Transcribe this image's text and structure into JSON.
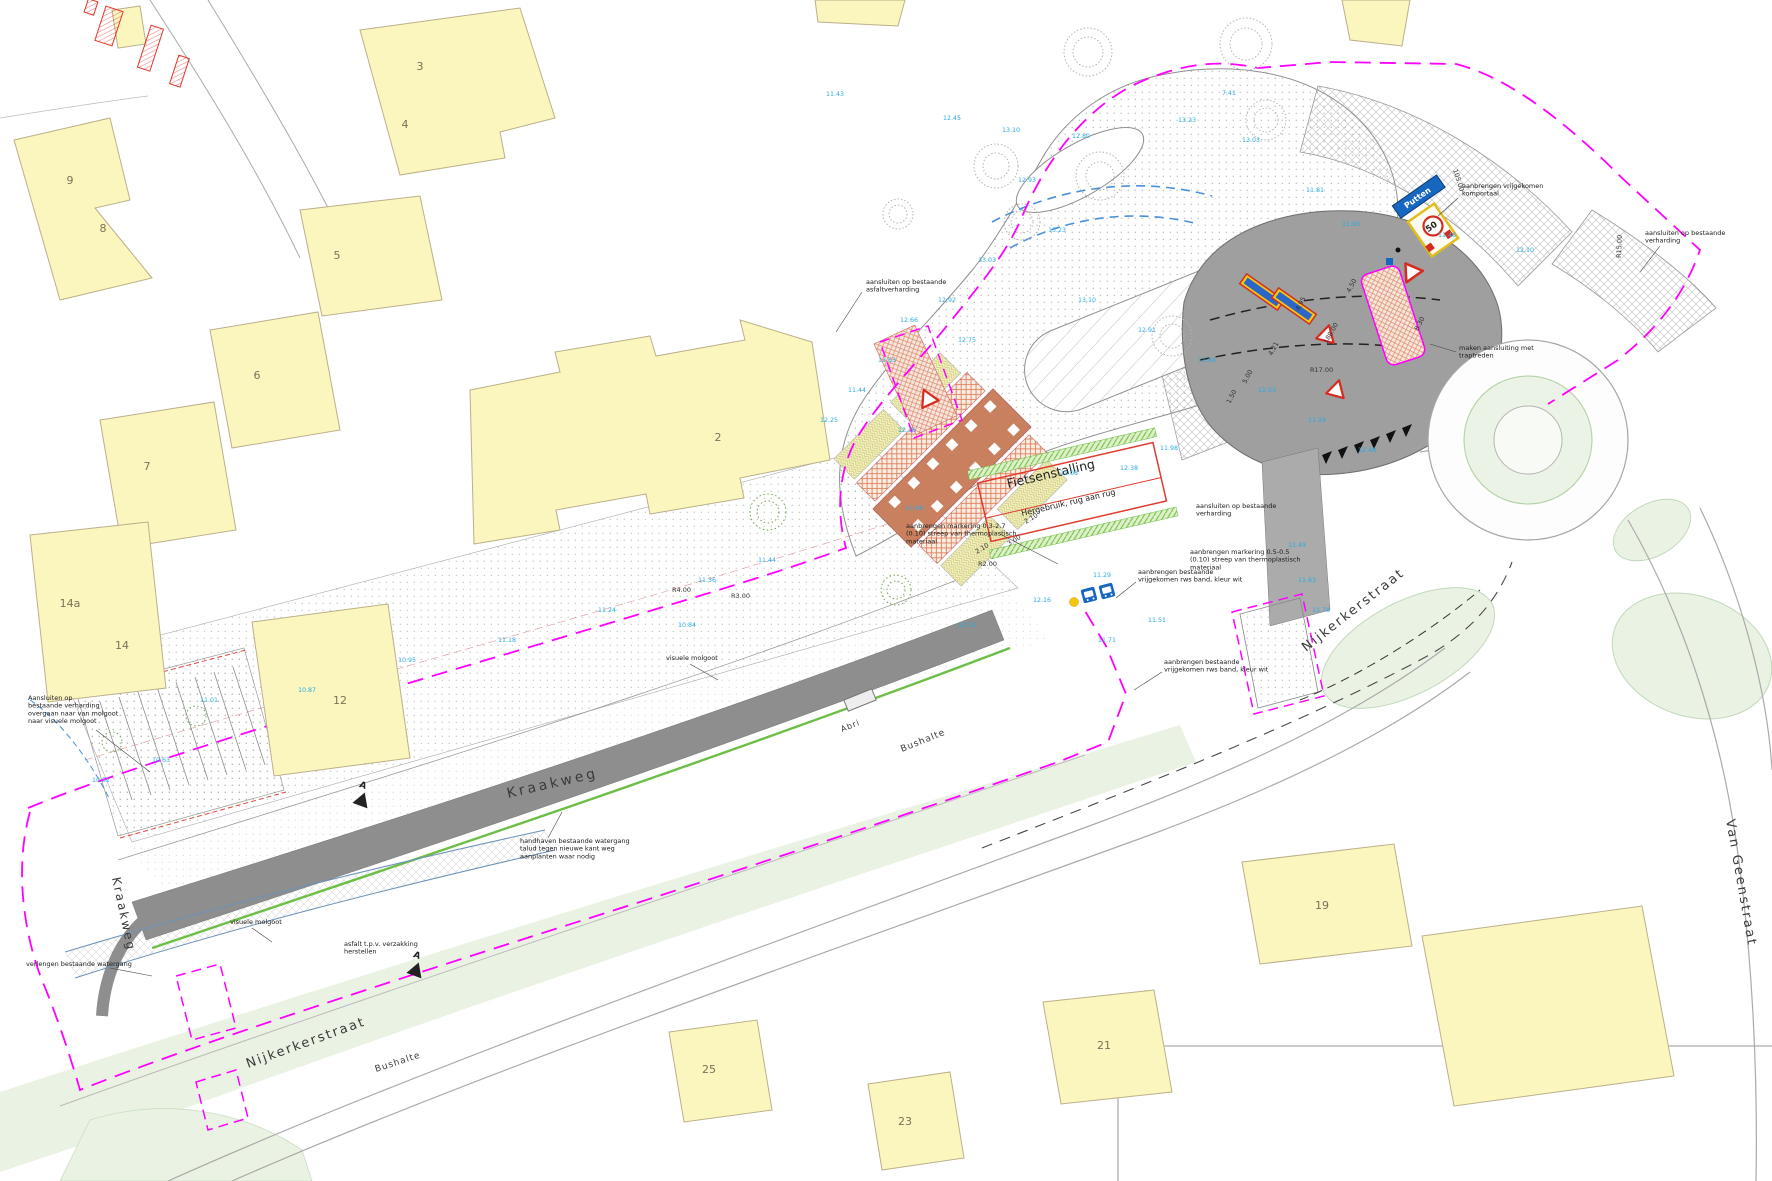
{
  "drawing": {
    "colors": {
      "boundary_magenta": "#FF00FF",
      "spot_height_cyan": "#29ABE2",
      "building_fill": "#FBF5BE",
      "grass_green": "#E9F2E3",
      "sign_blue": "#1766C0",
      "marking_red": "#D62B1F",
      "bikepark_green": "#6CBE45",
      "asphalt_gray": "#8E8E8E"
    },
    "streets": [
      {
        "name": "Kraakweg",
        "x": 508,
        "y": 798,
        "rotate": -13,
        "size": 14,
        "spacing": 3
      },
      {
        "name": "Kraakweg",
        "x": 112,
        "y": 878,
        "rotate": 78,
        "size": 12,
        "spacing": 2
      },
      {
        "name": "Nijkerkerstraat",
        "x": 248,
        "y": 1068,
        "rotate": -20,
        "size": 13,
        "spacing": 2
      },
      {
        "name": "Nijkerkerstraat",
        "x": 1306,
        "y": 652,
        "rotate": -38,
        "size": 13,
        "spacing": 2
      },
      {
        "name": "Van Geenstraat",
        "x": 1726,
        "y": 820,
        "rotate": 80,
        "size": 13,
        "spacing": 2
      },
      {
        "name": "Bushalte",
        "x": 376,
        "y": 1072,
        "rotate": -18,
        "size": 9,
        "spacing": 1
      },
      {
        "name": "Bushalte",
        "x": 902,
        "y": 752,
        "rotate": -22,
        "size": 9,
        "spacing": 1
      },
      {
        "name": "Abri",
        "x": 842,
        "y": 732,
        "rotate": -22,
        "size": 8,
        "spacing": 1
      }
    ],
    "buildings": [
      {
        "number": "3",
        "x": 420,
        "y": 70
      },
      {
        "number": "4",
        "x": 405,
        "y": 128
      },
      {
        "number": "9",
        "x": 70,
        "y": 184
      },
      {
        "number": "8",
        "x": 103,
        "y": 232
      },
      {
        "number": "5",
        "x": 337,
        "y": 259
      },
      {
        "number": "6",
        "x": 257,
        "y": 379
      },
      {
        "number": "7",
        "x": 147,
        "y": 470
      },
      {
        "number": "2",
        "x": 718,
        "y": 441
      },
      {
        "number": "14a",
        "x": 70,
        "y": 607
      },
      {
        "number": "14",
        "x": 122,
        "y": 649
      },
      {
        "number": "12",
        "x": 340,
        "y": 704
      },
      {
        "number": "19",
        "x": 1322,
        "y": 909
      },
      {
        "number": "21",
        "x": 1104,
        "y": 1049
      },
      {
        "number": "25",
        "x": 709,
        "y": 1073
      },
      {
        "number": "23",
        "x": 905,
        "y": 1125
      }
    ],
    "annotations": [
      {
        "key": "aansluiten-asfalt",
        "x": 866,
        "y": 284,
        "lines": [
          "aansluiten op bestaande",
          "asfaltverharding"
        ],
        "leader": [
          862,
          292,
          836,
          332
        ]
      },
      {
        "key": "komportaal",
        "x": 1462,
        "y": 188,
        "lines": [
          "aanbrengen vrijgekomen",
          "komportaal"
        ],
        "leader": [
          1458,
          198,
          1438,
          216
        ]
      },
      {
        "key": "aansluiten-verharding-noordoost",
        "x": 1645,
        "y": 235,
        "lines": [
          "aansluiten op bestaande",
          "verharding"
        ],
        "leader": [
          1660,
          246,
          1640,
          272
        ]
      },
      {
        "key": "traptreden",
        "x": 1459,
        "y": 350,
        "lines": [
          "maken aansluiting met",
          "traptreden"
        ],
        "leader": [
          1456,
          352,
          1430,
          344
        ]
      },
      {
        "key": "markering-03-27",
        "x": 906,
        "y": 528,
        "lines": [
          "aanbrengen markering 0.3-2.7",
          "(0.10) streep van thermoplastisch",
          "materiaal"
        ],
        "leader": [
          1000,
          534,
          1058,
          564
        ]
      },
      {
        "key": "aansluiten-verharding-oost",
        "x": 1196,
        "y": 508,
        "lines": [
          "aansluiten op bestaande",
          "verharding"
        ]
      },
      {
        "key": "markering-05-05",
        "x": 1190,
        "y": 554,
        "lines": [
          "aanbrengen markering 0.5-0.5",
          "(0.10) streep van thermoplastisch",
          "materiaal"
        ]
      },
      {
        "key": "rws-band-1",
        "x": 1138,
        "y": 574,
        "lines": [
          "aanbrengen bestaande",
          "vrijgekomen rws band, kleur wit"
        ],
        "leader": [
          1136,
          582,
          1116,
          598
        ]
      },
      {
        "key": "rws-band-2",
        "x": 1164,
        "y": 664,
        "lines": [
          "aanbrengen bestaande",
          "vrijgekomen rws band, kleur wit"
        ],
        "leader": [
          1162,
          672,
          1134,
          690
        ]
      },
      {
        "key": "molgoot-overgang",
        "x": 28,
        "y": 700,
        "lines": [
          "Aansluiten op",
          "bestaande verharding",
          "overgaan naar van molgoot",
          "naar visuele molgoot"
        ],
        "leader": [
          96,
          730,
          150,
          772
        ]
      },
      {
        "key": "watergang-verlengen",
        "x": 26,
        "y": 966,
        "lines": [
          "verlengen bestaande watergang"
        ],
        "leader": [
          110,
          968,
          152,
          976
        ]
      },
      {
        "key": "watergang-handhaven",
        "x": 520,
        "y": 843,
        "lines": [
          "handhaven bestaande watergang",
          "talud tegen nieuwe kant weg",
          "aanplanten waar nodig"
        ],
        "leader": [
          548,
          838,
          562,
          812
        ]
      },
      {
        "key": "visuele-molgoot-1",
        "x": 666,
        "y": 660,
        "lines": [
          "visuele molgoot"
        ],
        "leader": [
          690,
          664,
          718,
          680
        ]
      },
      {
        "key": "visuele-molgoot-2",
        "x": 230,
        "y": 924,
        "lines": [
          "visuele molgoot"
        ],
        "leader": [
          252,
          928,
          272,
          942
        ]
      },
      {
        "key": "asfalt-herstel",
        "x": 344,
        "y": 946,
        "lines": [
          "asfalt t.p.v. verzakking",
          "herstellen"
        ]
      }
    ],
    "poi": [
      {
        "label": "Fietsenstalling",
        "x": 1008,
        "y": 488,
        "rotate": -13,
        "size": 12.5
      },
      {
        "label": "Hergebruik, rug aan rug",
        "x": 1022,
        "y": 516,
        "rotate": -13,
        "size": 8
      }
    ],
    "signs": {
      "direction_label": "Putten",
      "speed_limit": "50"
    },
    "section_markers": [
      {
        "label": "A",
        "x": 362,
        "y": 788,
        "rotate": 20
      },
      {
        "label": "A",
        "x": 416,
        "y": 958,
        "rotate": 20
      }
    ],
    "dimensions": [
      {
        "text": "R15.00",
        "x": 1621,
        "y": 258,
        "rotate": -88
      },
      {
        "text": "R17.00",
        "x": 1310,
        "y": 372,
        "rotate": 0
      },
      {
        "text": "188.00",
        "x": 1327,
        "y": 344,
        "rotate": -60
      },
      {
        "text": "105.00",
        "x": 1453,
        "y": 170,
        "rotate": 72
      },
      {
        "text": "R2.00",
        "x": 978,
        "y": 566,
        "rotate": 0
      },
      {
        "text": "R4.00",
        "x": 672,
        "y": 592,
        "rotate": 0
      },
      {
        "text": "R3.00",
        "x": 731,
        "y": 598,
        "rotate": 0
      },
      {
        "text": "2.10",
        "x": 1026,
        "y": 524,
        "rotate": -32
      },
      {
        "text": "3.00",
        "x": 1009,
        "y": 546,
        "rotate": -32
      },
      {
        "text": "2.10",
        "x": 977,
        "y": 554,
        "rotate": -32
      },
      {
        "text": "4.21",
        "x": 1272,
        "y": 356,
        "rotate": -62
      },
      {
        "text": "4.95",
        "x": 1299,
        "y": 311,
        "rotate": -62
      },
      {
        "text": "4.50",
        "x": 1350,
        "y": 293,
        "rotate": -62
      },
      {
        "text": "8.30",
        "x": 1418,
        "y": 331,
        "rotate": -62
      },
      {
        "text": "5.00",
        "x": 1246,
        "y": 384,
        "rotate": -62
      },
      {
        "text": "1.50",
        "x": 1230,
        "y": 404,
        "rotate": -62
      }
    ],
    "spot_heights": [
      {
        "v": "11.43",
        "x": 826,
        "y": 96
      },
      {
        "v": "12.45",
        "x": 943,
        "y": 120
      },
      {
        "v": "13.10",
        "x": 1002,
        "y": 132
      },
      {
        "v": "12.80",
        "x": 1072,
        "y": 138
      },
      {
        "v": "13.23",
        "x": 1178,
        "y": 122
      },
      {
        "v": "13.03",
        "x": 1242,
        "y": 142
      },
      {
        "v": "11.81",
        "x": 1306,
        "y": 192
      },
      {
        "v": "11.95",
        "x": 1342,
        "y": 226
      },
      {
        "v": "11.48",
        "x": 1438,
        "y": 237
      },
      {
        "v": "12.10",
        "x": 1516,
        "y": 252
      },
      {
        "v": "12.93",
        "x": 1018,
        "y": 182
      },
      {
        "v": "13.23",
        "x": 1048,
        "y": 232
      },
      {
        "v": "13.03",
        "x": 978,
        "y": 262
      },
      {
        "v": "12.92",
        "x": 938,
        "y": 302
      },
      {
        "v": "12.66",
        "x": 900,
        "y": 322
      },
      {
        "v": "12.75",
        "x": 958,
        "y": 342
      },
      {
        "v": "13.63",
        "x": 878,
        "y": 362
      },
      {
        "v": "11.44",
        "x": 848,
        "y": 392
      },
      {
        "v": "12.25",
        "x": 820,
        "y": 422
      },
      {
        "v": "12.16",
        "x": 898,
        "y": 432
      },
      {
        "v": "13.10",
        "x": 1078,
        "y": 302
      },
      {
        "v": "12.91",
        "x": 1138,
        "y": 332
      },
      {
        "v": "11.84",
        "x": 1198,
        "y": 362
      },
      {
        "v": "12.03",
        "x": 1258,
        "y": 392
      },
      {
        "v": "11.29",
        "x": 1308,
        "y": 422
      },
      {
        "v": "12.48",
        "x": 1358,
        "y": 452
      },
      {
        "v": "11.71",
        "x": 1098,
        "y": 642
      },
      {
        "v": "11.51",
        "x": 1148,
        "y": 622
      },
      {
        "v": "11.49",
        "x": 1288,
        "y": 547
      },
      {
        "v": "11.63",
        "x": 1298,
        "y": 582
      },
      {
        "v": "11.78",
        "x": 1312,
        "y": 612
      },
      {
        "v": "12.16",
        "x": 1033,
        "y": 602
      },
      {
        "v": "11.29",
        "x": 1093,
        "y": 577
      },
      {
        "v": "12.10",
        "x": 958,
        "y": 627
      },
      {
        "v": "11.01",
        "x": 200,
        "y": 702
      },
      {
        "v": "10.87",
        "x": 298,
        "y": 692
      },
      {
        "v": "10.95",
        "x": 398,
        "y": 662
      },
      {
        "v": "11.18",
        "x": 498,
        "y": 642
      },
      {
        "v": "11.24",
        "x": 598,
        "y": 612
      },
      {
        "v": "11.36",
        "x": 698,
        "y": 582
      },
      {
        "v": "11.44",
        "x": 758,
        "y": 562
      },
      {
        "v": "10.52",
        "x": 92,
        "y": 782
      },
      {
        "v": "10.63",
        "x": 152,
        "y": 762
      },
      {
        "v": "10.84",
        "x": 678,
        "y": 627
      },
      {
        "v": "12.38",
        "x": 1120,
        "y": 470
      },
      {
        "v": "11.98",
        "x": 1160,
        "y": 450
      },
      {
        "v": "11.08",
        "x": 1060,
        "y": 475
      },
      {
        "v": "10.98",
        "x": 905,
        "y": 510
      },
      {
        "v": "7.41",
        "x": 1222,
        "y": 95
      }
    ]
  }
}
